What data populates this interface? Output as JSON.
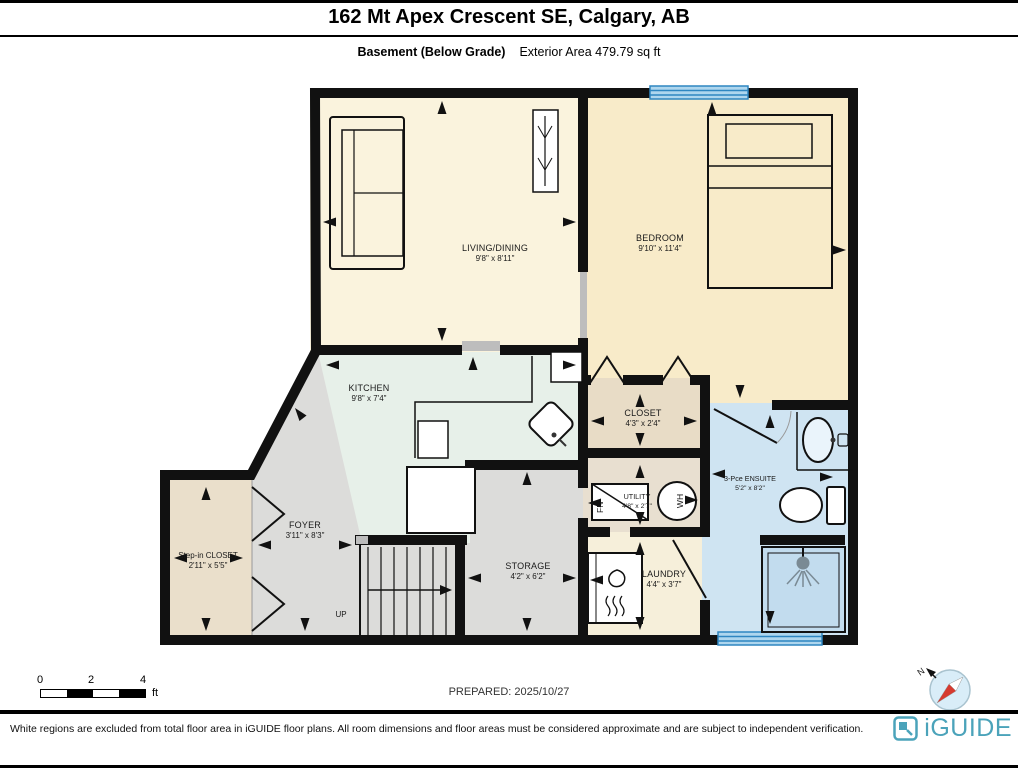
{
  "header": {
    "title": "162 Mt Apex Crescent SE, Calgary, AB",
    "floor_label": "Basement (Below Grade)",
    "area_label": "Exterior Area 479.79 sq ft"
  },
  "rooms": {
    "living": {
      "name": "LIVING/DINING",
      "dims": "9'8\" x 8'11\""
    },
    "bedroom": {
      "name": "BEDROOM",
      "dims": "9'10\" x 11'4\""
    },
    "kitchen": {
      "name": "KITCHEN",
      "dims": "9'8\" x 7'4\""
    },
    "closet": {
      "name": "CLOSET",
      "dims": "4'3\" x 2'4\""
    },
    "ensuite": {
      "name": "3-Pce ENSUITE",
      "dims": "5'2\" x 8'2\""
    },
    "utility": {
      "name": "UTILITY",
      "dims": "4'8\" x 2'7\""
    },
    "laundry": {
      "name": "LAUNDRY",
      "dims": "4'4\" x 3'7\""
    },
    "storage": {
      "name": "STORAGE",
      "dims": "4'2\" x 6'2\""
    },
    "foyer": {
      "name": "FOYER",
      "dims": "3'11\" x 8'3\""
    },
    "step_in_closet": {
      "name": "Step-in CLOSET",
      "dims": "2'11\" x 5'5\""
    }
  },
  "annotations": {
    "up": "UP",
    "furnace": "FN",
    "water_heater": "WH",
    "north": "N"
  },
  "scale_bar": {
    "t0": "0",
    "t2": "2",
    "t4": "4",
    "unit": "ft"
  },
  "footer": {
    "prepared": "PREPARED: 2025/10/27",
    "disclaimer": "White regions are excluded from total floor area in iGUIDE floor plans. All room dimensions and floor areas must be considered approximate and are subject to independent verification.",
    "brand": "iGUIDE"
  },
  "colors": {
    "logo_teal": "#4BA3BA",
    "window_blue": "#2E86C1",
    "window_fill": "#AED6EE",
    "compass_red": "#D63A2F"
  }
}
